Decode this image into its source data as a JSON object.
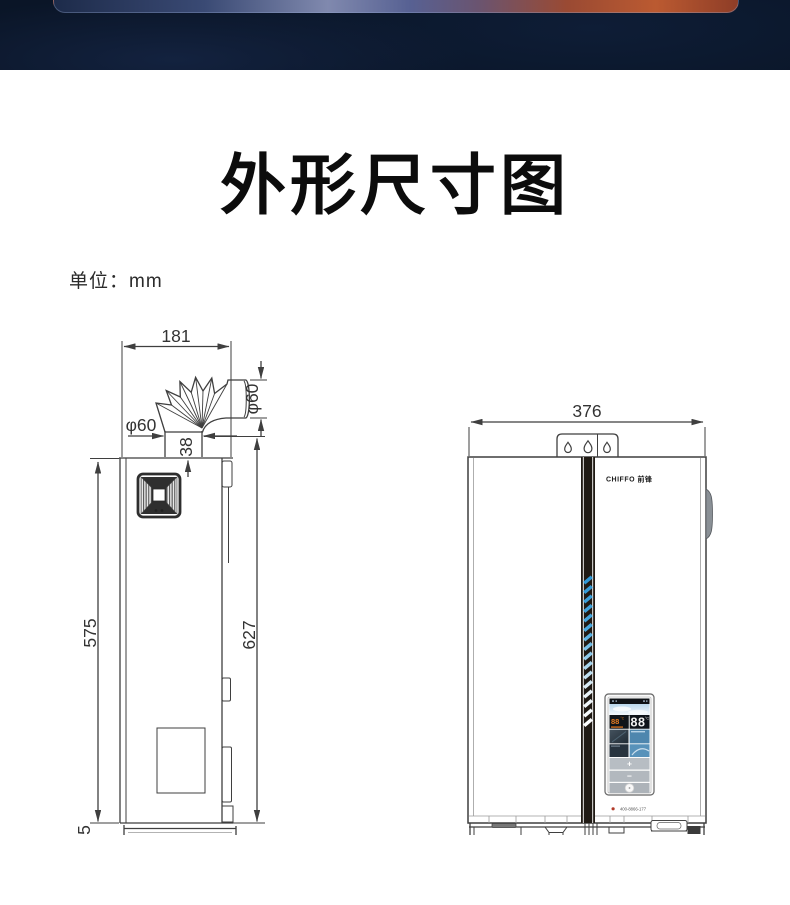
{
  "title": "外形尺寸图",
  "unit_label": "单位：mm",
  "side_view": {
    "dim_width": "181",
    "dim_duct_diameter_v": "φ60",
    "dim_duct_diameter_h": "φ60",
    "dim_collar": "38",
    "dim_body_height": "575",
    "dim_total_height": "627",
    "dim_base": "5"
  },
  "front_view": {
    "dim_width": "376",
    "brand": "CHIFFO 前锋",
    "display": {
      "temp_left": "88",
      "temp_left_unit": "°C",
      "temp_right": "88",
      "temp_right_unit": "°C",
      "btn_plus": "+",
      "btn_minus": "−"
    },
    "hotline": "400-8866-177"
  },
  "colors": {
    "banner_bg": "#0a1527",
    "line": "#3f3f3f",
    "accent_dash_blue": "#2e96d4",
    "temp_orange": "#e87d22"
  }
}
